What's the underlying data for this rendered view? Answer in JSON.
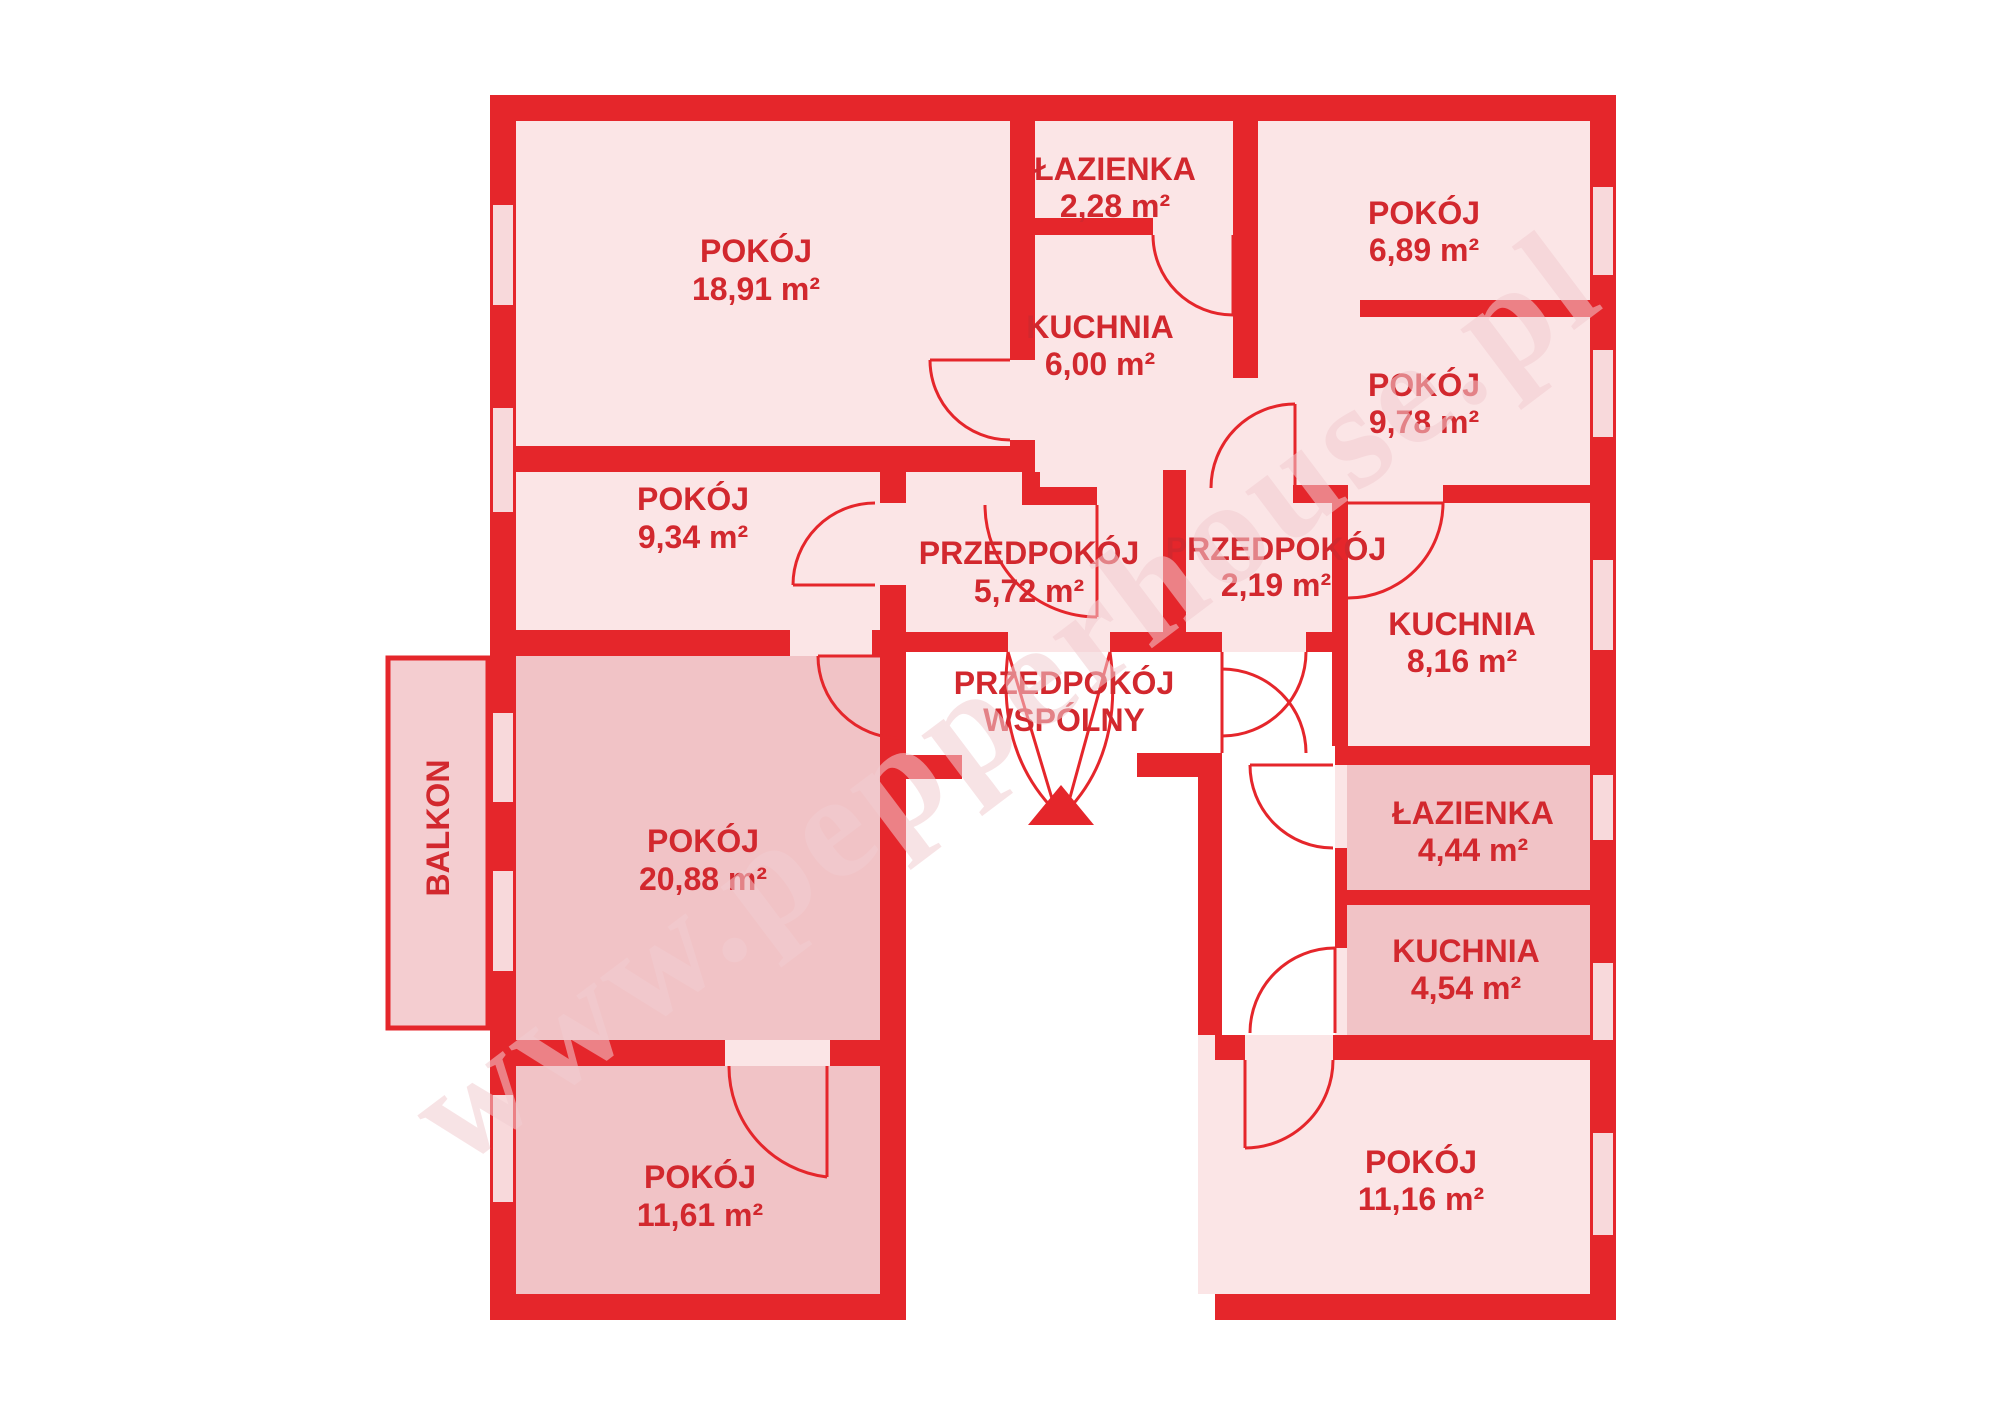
{
  "watermark": "www.pepperhouse.pl",
  "balcony": {
    "label": "BALKON"
  },
  "shared_hall": {
    "line1": "PRZEDPOKÓJ",
    "line2": "WSPÓLNY"
  },
  "rooms": [
    {
      "name": "POKÓJ",
      "area": "18,91 m²"
    },
    {
      "name": "POKÓJ",
      "area": "9,34 m²"
    },
    {
      "name": "POKÓJ",
      "area": "20,88 m²"
    },
    {
      "name": "POKÓJ",
      "area": "11,61 m²"
    },
    {
      "name": "ŁAZIENKA",
      "area": "2,28 m²"
    },
    {
      "name": "KUCHNIA",
      "area": "6,00 m²"
    },
    {
      "name": "PRZEDPOKÓJ",
      "area": "5,72 m²"
    },
    {
      "name": "POKÓJ",
      "area": "6,89 m²"
    },
    {
      "name": "POKÓJ",
      "area": "9,78 m²"
    },
    {
      "name": "PRZEDPOKÓJ",
      "area": "2,19 m²"
    },
    {
      "name": "KUCHNIA",
      "area": "8,16 m²"
    },
    {
      "name": "ŁAZIENKA",
      "area": "4,44 m²"
    },
    {
      "name": "KUCHNIA",
      "area": "4,54 m²"
    },
    {
      "name": "POKÓJ",
      "area": "11,16 m²"
    }
  ],
  "colors": {
    "wall": "#e5262b",
    "light": "#fbe5e6",
    "dark": "#f1c3c6",
    "white": "#ffffff",
    "window": "#f8d9db",
    "text": "#d2282e",
    "watermark": "#f2cdd1",
    "balcony": "#f4cdd0"
  }
}
